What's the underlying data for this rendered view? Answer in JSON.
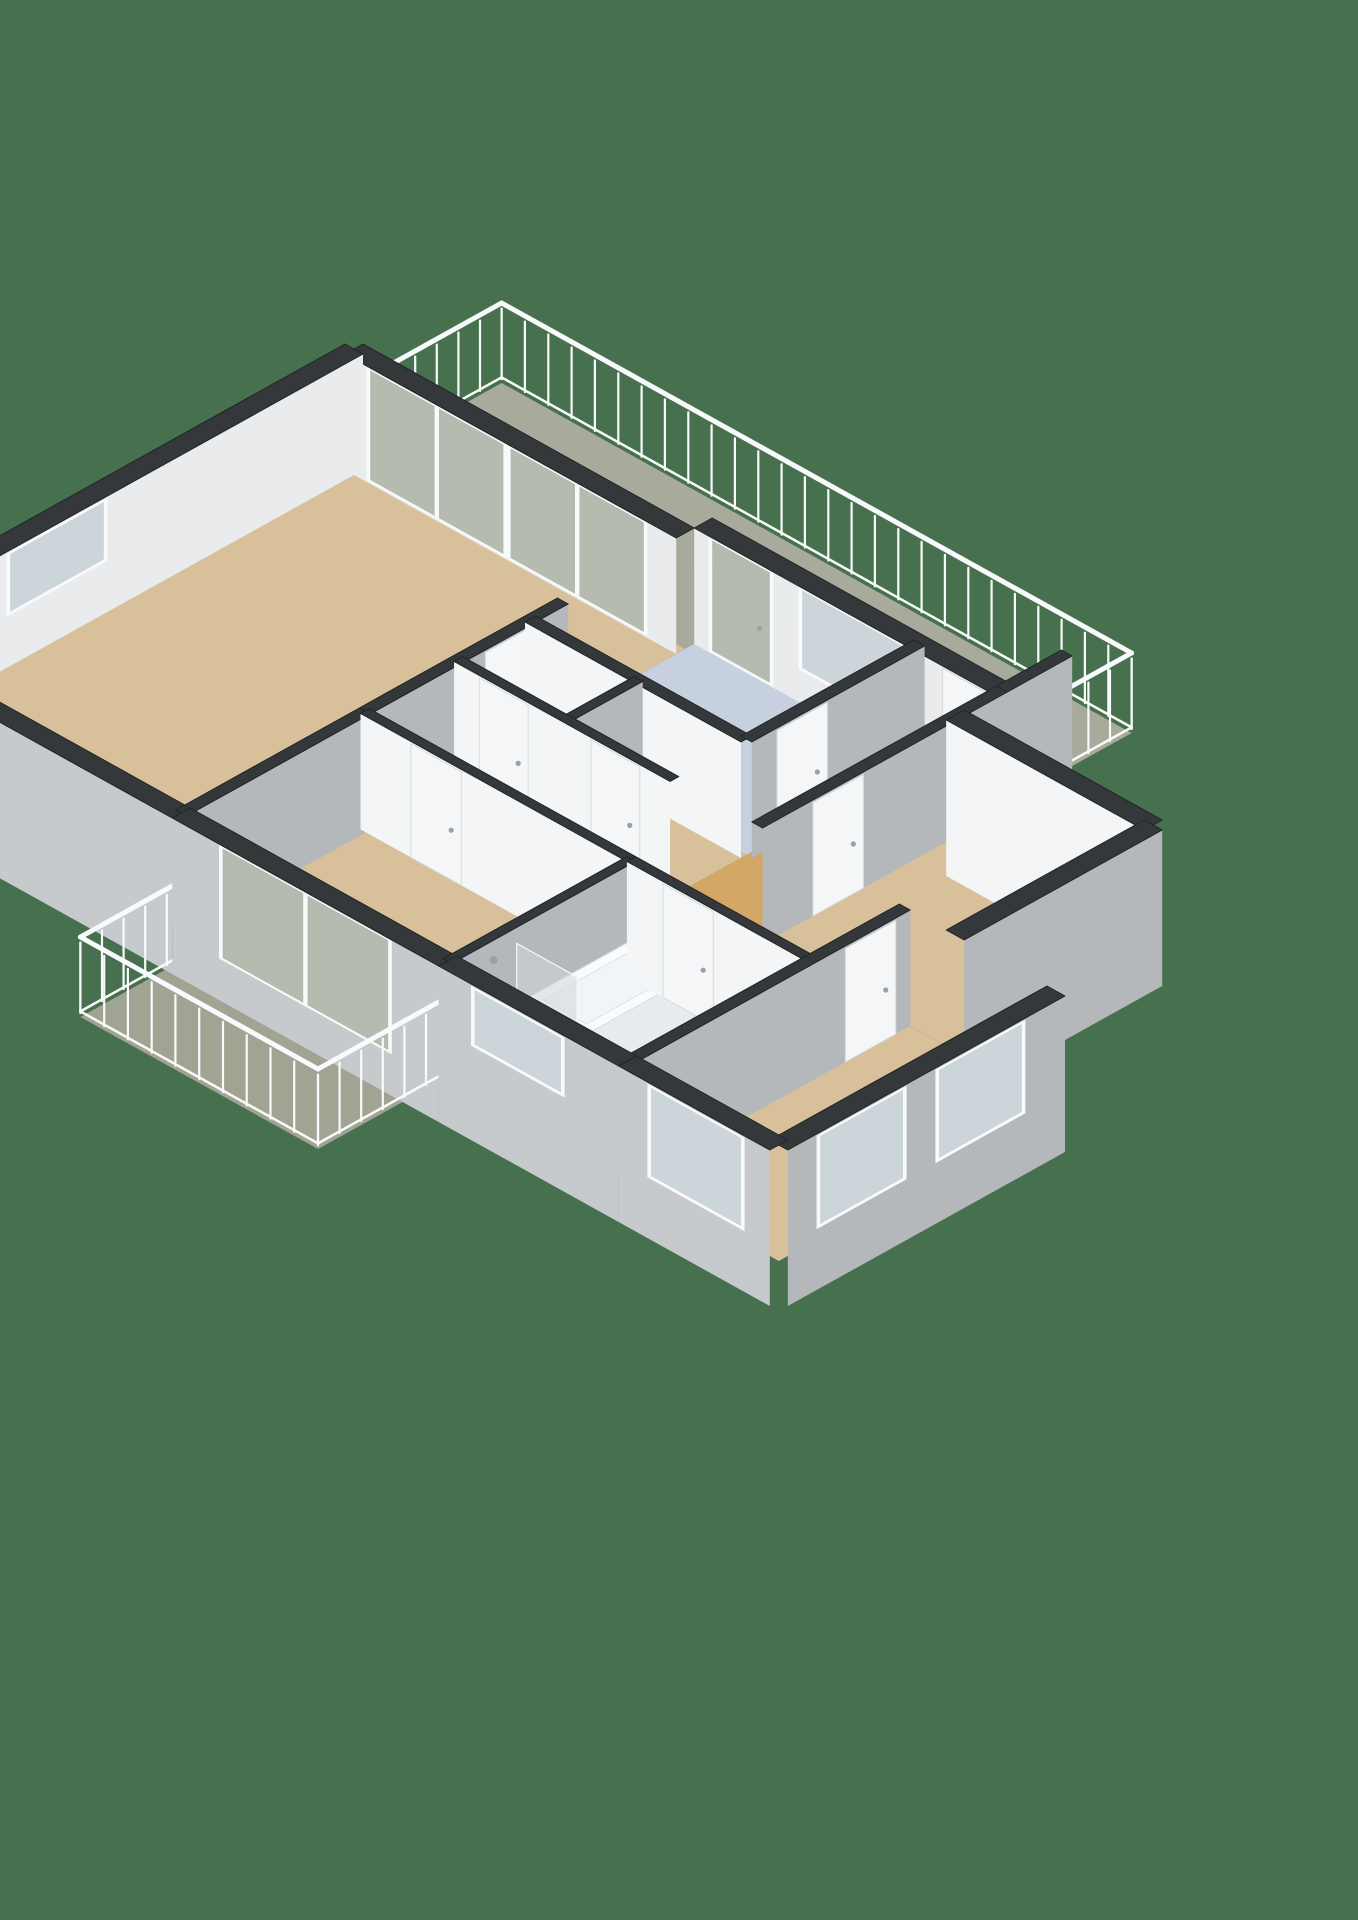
{
  "scene": {
    "kind": "3d-floor-plan-isometric-render",
    "view": "dollhouse-cutaway",
    "visible_text": ""
  },
  "floorplan": {
    "projection": {
      "ox": -150,
      "oy": 745,
      "kx": 72,
      "ky": 40,
      "kz": 80,
      "wall_h": 1.45,
      "ext_base": -0.5
    },
    "colors": {
      "background": "#47714e",
      "capTop": "#34383b",
      "capStroke": "#212426",
      "faceGray": "#b4b8bb",
      "faceLight": "#e9ebed",
      "faceWhite": "#f3f5f6",
      "faceExt": "#c7cacc",
      "floorTan": "#d7c09a",
      "floorHall": "#d3a766",
      "floorKitchen": "#c6d0de",
      "floorBath": "#dce3ea",
      "floorToilet": "#e2e6ea",
      "floorBalcony": "#a8ab9b",
      "floorBalconyWest": "#a1a493",
      "glass": "#ccd5da",
      "glassBalcony": "#b6bbaf",
      "glassPanel": "#cfd7db",
      "frame": "#f8fafb",
      "doorLeaf": "#f4f6f7",
      "doorEdge": "#d8dbdd",
      "handle": "#9aa0a5",
      "railing": "#f8fafb",
      "fixtureTop": "#fafbfc",
      "fixtureSide": "#e8ebed",
      "fixtureWest": "#f0f2f4",
      "fixtureEdge": "#d9dcde",
      "tubInner": "#f2f5f7",
      "trayFill": "#e4eaf0"
    },
    "rooms": [
      {
        "name": "living-room",
        "color": "floorTan",
        "poly": [
          [
            0,
            0
          ],
          [
            7,
            0
          ],
          [
            7,
            4.6
          ],
          [
            0,
            4.6
          ]
        ]
      },
      {
        "name": "gallery-balcony",
        "color": "floorBalcony",
        "poly": [
          [
            7,
            0
          ],
          [
            9.05,
            0
          ],
          [
            9.05,
            8.75
          ],
          [
            7,
            8.75
          ]
        ]
      },
      {
        "name": "kitchen",
        "color": "floorKitchen",
        "poly": [
          [
            4.85,
            4.6
          ],
          [
            7.25,
            4.6
          ],
          [
            7.25,
            7.6
          ],
          [
            4.85,
            7.6
          ]
        ]
      },
      {
        "name": "toilet-room",
        "color": "floorToilet",
        "poly": [
          [
            3.85,
            4.6
          ],
          [
            4.85,
            4.6
          ],
          [
            4.85,
            6.1
          ],
          [
            3.85,
            6.1
          ]
        ]
      },
      {
        "name": "storage-room",
        "color": "floorTan",
        "poly": [
          [
            3.85,
            6.1
          ],
          [
            4.85,
            6.1
          ],
          [
            4.85,
            7.6
          ],
          [
            3.85,
            7.6
          ]
        ]
      },
      {
        "name": "hallway",
        "color": "floorHall",
        "poly": [
          [
            2.55,
            4.6
          ],
          [
            3.85,
            4.6
          ],
          [
            3.85,
            7.6
          ],
          [
            7.25,
            7.6
          ],
          [
            7.25,
            8.75
          ],
          [
            3.85,
            8.75
          ],
          [
            3.85,
            10.8
          ],
          [
            2.55,
            10.8
          ]
        ]
      },
      {
        "name": "bedroom-1",
        "color": "floorTan",
        "poly": [
          [
            0,
            4.6
          ],
          [
            2.55,
            4.6
          ],
          [
            2.55,
            8.3
          ],
          [
            0,
            8.3
          ]
        ]
      },
      {
        "name": "west-balcony",
        "color": "floorBalconyWest",
        "poly": [
          [
            -1.8,
            5.0
          ],
          [
            0,
            5.0
          ],
          [
            0,
            8.3
          ],
          [
            -1.8,
            8.3
          ]
        ]
      },
      {
        "name": "bathroom",
        "color": "floorBath",
        "poly": [
          [
            0,
            8.3
          ],
          [
            2.55,
            8.3
          ],
          [
            2.55,
            10.8
          ],
          [
            0,
            10.8
          ]
        ]
      },
      {
        "name": "bedroom-2",
        "color": "floorTan",
        "poly": [
          [
            0,
            10.8
          ],
          [
            3.85,
            10.8
          ],
          [
            3.85,
            12.9
          ],
          [
            0,
            12.9
          ]
        ]
      },
      {
        "name": "bedroom-3",
        "color": "floorTan",
        "poly": [
          [
            3.85,
            8.75
          ],
          [
            6.6,
            8.75
          ],
          [
            6.6,
            11.5
          ],
          [
            3.85,
            11.5
          ]
        ]
      }
    ],
    "elements": [
      {
        "kind": "railing",
        "name": "gallery-railing-north",
        "x1": 7.25,
        "y1": 0,
        "x2": 9.05,
        "y2": 0
      },
      {
        "kind": "wall",
        "name": "living-gallery-wall",
        "x1": 7,
        "y1": 0,
        "x2": 7,
        "y2": 4.6,
        "t": 0.25,
        "shade": "light",
        "openings": [
          {
            "type": "slider",
            "d": 0.35,
            "w": 1.85,
            "z0": 0.05,
            "z1": 1.42
          },
          {
            "type": "slider",
            "d": 2.3,
            "w": 1.85,
            "z0": 0.05,
            "z1": 1.42
          }
        ]
      },
      {
        "kind": "railing",
        "name": "gallery-railing-east",
        "x1": 9.05,
        "y1": 0,
        "x2": 9.05,
        "y2": 8.75
      },
      {
        "kind": "wall",
        "name": "living-north-wall",
        "x1": 0,
        "y1": 0,
        "x2": 7,
        "y2": 0,
        "t": 0.25,
        "shade": "light",
        "openings": [
          {
            "type": "window",
            "d": 2.1,
            "w": 1.3,
            "z0": 0.68,
            "z1": 1.4
          }
        ]
      },
      {
        "kind": "wall",
        "name": "kitchen-gallery-wall",
        "x1": 7.25,
        "y1": 4.6,
        "x2": 7.25,
        "y2": 8.75,
        "t": 0.25,
        "shade": "light",
        "openings": [
          {
            "type": "glassdoor",
            "d": 0.25,
            "w": 0.8,
            "z0": 0.04,
            "z1": 1.42
          },
          {
            "type": "window",
            "d": 1.5,
            "w": 1.4,
            "z0": 0.45,
            "z1": 1.42
          },
          {
            "type": "door",
            "d": 3.45,
            "w": 0.6,
            "z0": 0,
            "z1": 1.42
          }
        ]
      },
      {
        "kind": "railing",
        "name": "gallery-railing-south",
        "x1": 8.15,
        "y1": 8.75,
        "x2": 9.05,
        "y2": 8.75
      },
      {
        "kind": "wall",
        "name": "gallery-end-wall",
        "x1": 7.25,
        "y1": 8.75,
        "x2": 8.15,
        "y2": 8.75,
        "t": 0.15,
        "shade": "gray"
      },
      {
        "kind": "wall",
        "name": "living-hall-wall",
        "x1": 2.55,
        "y1": 4.6,
        "x2": 5.3,
        "y2": 4.6,
        "t": 0.15,
        "shade": "gray",
        "openings": [
          {
            "type": "door",
            "d": 1.6,
            "w": 0.7,
            "z0": 0,
            "z1": 1.42
          }
        ]
      },
      {
        "kind": "box",
        "name": "toilet-cistern",
        "x1": 4.18,
        "y1": 5.02,
        "x2": 4.52,
        "y2": 5.28,
        "h": 0.78
      },
      {
        "kind": "box",
        "name": "toilet-bowl",
        "x1": 4.12,
        "y1": 5.28,
        "x2": 4.58,
        "y2": 5.85,
        "h": 0.42
      },
      {
        "kind": "wall",
        "name": "kitchen-west-wall",
        "x1": 4.85,
        "y1": 4.6,
        "x2": 4.85,
        "y2": 7.6,
        "t": 0.15,
        "shade": "white"
      },
      {
        "kind": "wall",
        "name": "kitchen-hall-wall",
        "x1": 4.85,
        "y1": 7.6,
        "x2": 7.25,
        "y2": 7.6,
        "t": 0.15,
        "shade": "gray",
        "openings": [
          {
            "type": "door",
            "d": 0.35,
            "w": 0.7,
            "z0": 0,
            "z1": 1.42
          }
        ]
      },
      {
        "kind": "wall",
        "name": "toilet-storage-wall",
        "x1": 3.85,
        "y1": 6.1,
        "x2": 4.85,
        "y2": 6.1,
        "t": 0.12,
        "shade": "gray"
      },
      {
        "kind": "wall",
        "name": "hall-east-wall",
        "x1": 3.85,
        "y1": 4.6,
        "x2": 3.85,
        "y2": 7.6,
        "t": 0.12,
        "shade": "white",
        "openings": [
          {
            "type": "door",
            "d": 0.35,
            "w": 0.68,
            "z0": 0,
            "z1": 1.42
          },
          {
            "type": "door",
            "d": 1.9,
            "w": 0.68,
            "z0": 0,
            "z1": 1.42
          }
        ]
      },
      {
        "kind": "wall",
        "name": "living-west-wall",
        "x1": 0,
        "y1": 0,
        "x2": 0,
        "y2": 4.6,
        "t": 0.25,
        "shade": "ext",
        "ext": true
      },
      {
        "kind": "wall",
        "name": "bed3-north-wall",
        "x1": 3.85,
        "y1": 8.75,
        "x2": 7.25,
        "y2": 8.75,
        "t": 0.15,
        "shade": "gray",
        "openings": [
          {
            "type": "door",
            "d": 0.7,
            "w": 0.7,
            "z0": 0,
            "z1": 1.42
          }
        ]
      },
      {
        "kind": "wall",
        "name": "bed1-north-wall",
        "x1": 0,
        "y1": 4.6,
        "x2": 2.55,
        "y2": 4.6,
        "t": 0.15,
        "shade": "gray"
      },
      {
        "kind": "wall",
        "name": "bed3-east-wall",
        "x1": 6.6,
        "y1": 8.75,
        "x2": 6.6,
        "y2": 11.5,
        "t": 0.25,
        "shade": "white",
        "ext": true
      },
      {
        "kind": "wall",
        "name": "bed1-hall-wall",
        "x1": 2.55,
        "y1": 4.6,
        "x2": 2.55,
        "y2": 8.3,
        "t": 0.12,
        "shade": "white",
        "openings": [
          {
            "type": "door",
            "d": 0.7,
            "w": 0.7,
            "z0": 0,
            "z1": 1.42
          }
        ]
      },
      {
        "kind": "railing",
        "name": "west-balcony-railing-north",
        "x1": -1.8,
        "y1": 5.0,
        "x2": 0,
        "y2": 5.0
      },
      {
        "kind": "wall",
        "name": "bed3-south-wall",
        "x1": 3.85,
        "y1": 11.5,
        "x2": 6.6,
        "y2": 11.5,
        "t": 0.25,
        "shade": "gray",
        "ext": true
      },
      {
        "kind": "wall",
        "name": "bed1-west-wall",
        "x1": 0,
        "y1": 4.6,
        "x2": 0,
        "y2": 8.3,
        "t": 0.25,
        "shade": "ext",
        "ext": true,
        "openings": [
          {
            "type": "slider",
            "d": 0.7,
            "w": 2.3,
            "z0": 0.05,
            "z1": 1.42
          }
        ]
      },
      {
        "kind": "wall",
        "name": "bath-north-wall",
        "x1": 0,
        "y1": 8.3,
        "x2": 2.55,
        "y2": 8.3,
        "t": 0.12,
        "shade": "gray"
      },
      {
        "kind": "mat",
        "name": "shower-tray",
        "x1": 0.12,
        "y1": 8.42,
        "x2": 0.85,
        "y2": 9.18
      },
      {
        "kind": "box",
        "name": "bathtub",
        "x1": 0.95,
        "y1": 8.42,
        "x2": 2.42,
        "y2": 9.28,
        "h": 0.55,
        "inner": true
      },
      {
        "kind": "panel",
        "name": "shower-glass",
        "x": 0.9,
        "y1": 8.36,
        "y2": 9.2,
        "h": 1.25
      },
      {
        "kind": "dot",
        "name": "shower-head",
        "x": 0.5,
        "y": 8.44,
        "z": 1.28,
        "r": 4
      },
      {
        "kind": "wall",
        "name": "bath-hall-wall",
        "x1": 2.55,
        "y1": 8.3,
        "x2": 2.55,
        "y2": 10.8,
        "t": 0.12,
        "shade": "white",
        "openings": [
          {
            "type": "door",
            "d": 0.5,
            "w": 0.7,
            "z0": 0,
            "z1": 1.42
          }
        ]
      },
      {
        "kind": "railing",
        "name": "west-balcony-railing-west",
        "x1": -1.8,
        "y1": 5.0,
        "x2": -1.8,
        "y2": 8.3
      },
      {
        "kind": "wall",
        "name": "bath-bed2-wall",
        "x1": 0,
        "y1": 10.8,
        "x2": 3.85,
        "y2": 10.8,
        "t": 0.15,
        "shade": "gray",
        "openings": [
          {
            "type": "door",
            "d": 2.95,
            "w": 0.7,
            "z0": 0,
            "z1": 1.42
          }
        ]
      },
      {
        "kind": "railing",
        "name": "west-balcony-railing-south",
        "x1": -1.8,
        "y1": 8.3,
        "x2": 0,
        "y2": 8.3
      },
      {
        "kind": "wall",
        "name": "bath-west-wall",
        "x1": 0,
        "y1": 8.3,
        "x2": 0,
        "y2": 10.8,
        "t": 0.25,
        "shade": "ext",
        "ext": true,
        "openings": [
          {
            "type": "window",
            "d": 0.5,
            "w": 1.2,
            "z0": 0.72,
            "z1": 1.4
          }
        ]
      },
      {
        "kind": "wall",
        "name": "bed2-south-wall",
        "x1": 0,
        "y1": 12.9,
        "x2": 3.85,
        "y2": 12.9,
        "t": 0.25,
        "shade": "gray",
        "ext": true,
        "openings": [
          {
            "type": "window",
            "d": 0.45,
            "w": 1.15,
            "z0": 0.3,
            "z1": 1.4
          },
          {
            "type": "window",
            "d": 2.1,
            "w": 1.15,
            "z0": 0.3,
            "z1": 1.4
          }
        ]
      },
      {
        "kind": "wall",
        "name": "bed2-west-wall",
        "x1": 0,
        "y1": 10.8,
        "x2": 0,
        "y2": 12.9,
        "t": 0.25,
        "shade": "ext",
        "ext": true,
        "openings": [
          {
            "type": "window",
            "d": 0.45,
            "w": 1.25,
            "z0": 0.3,
            "z1": 1.4
          }
        ]
      }
    ]
  }
}
